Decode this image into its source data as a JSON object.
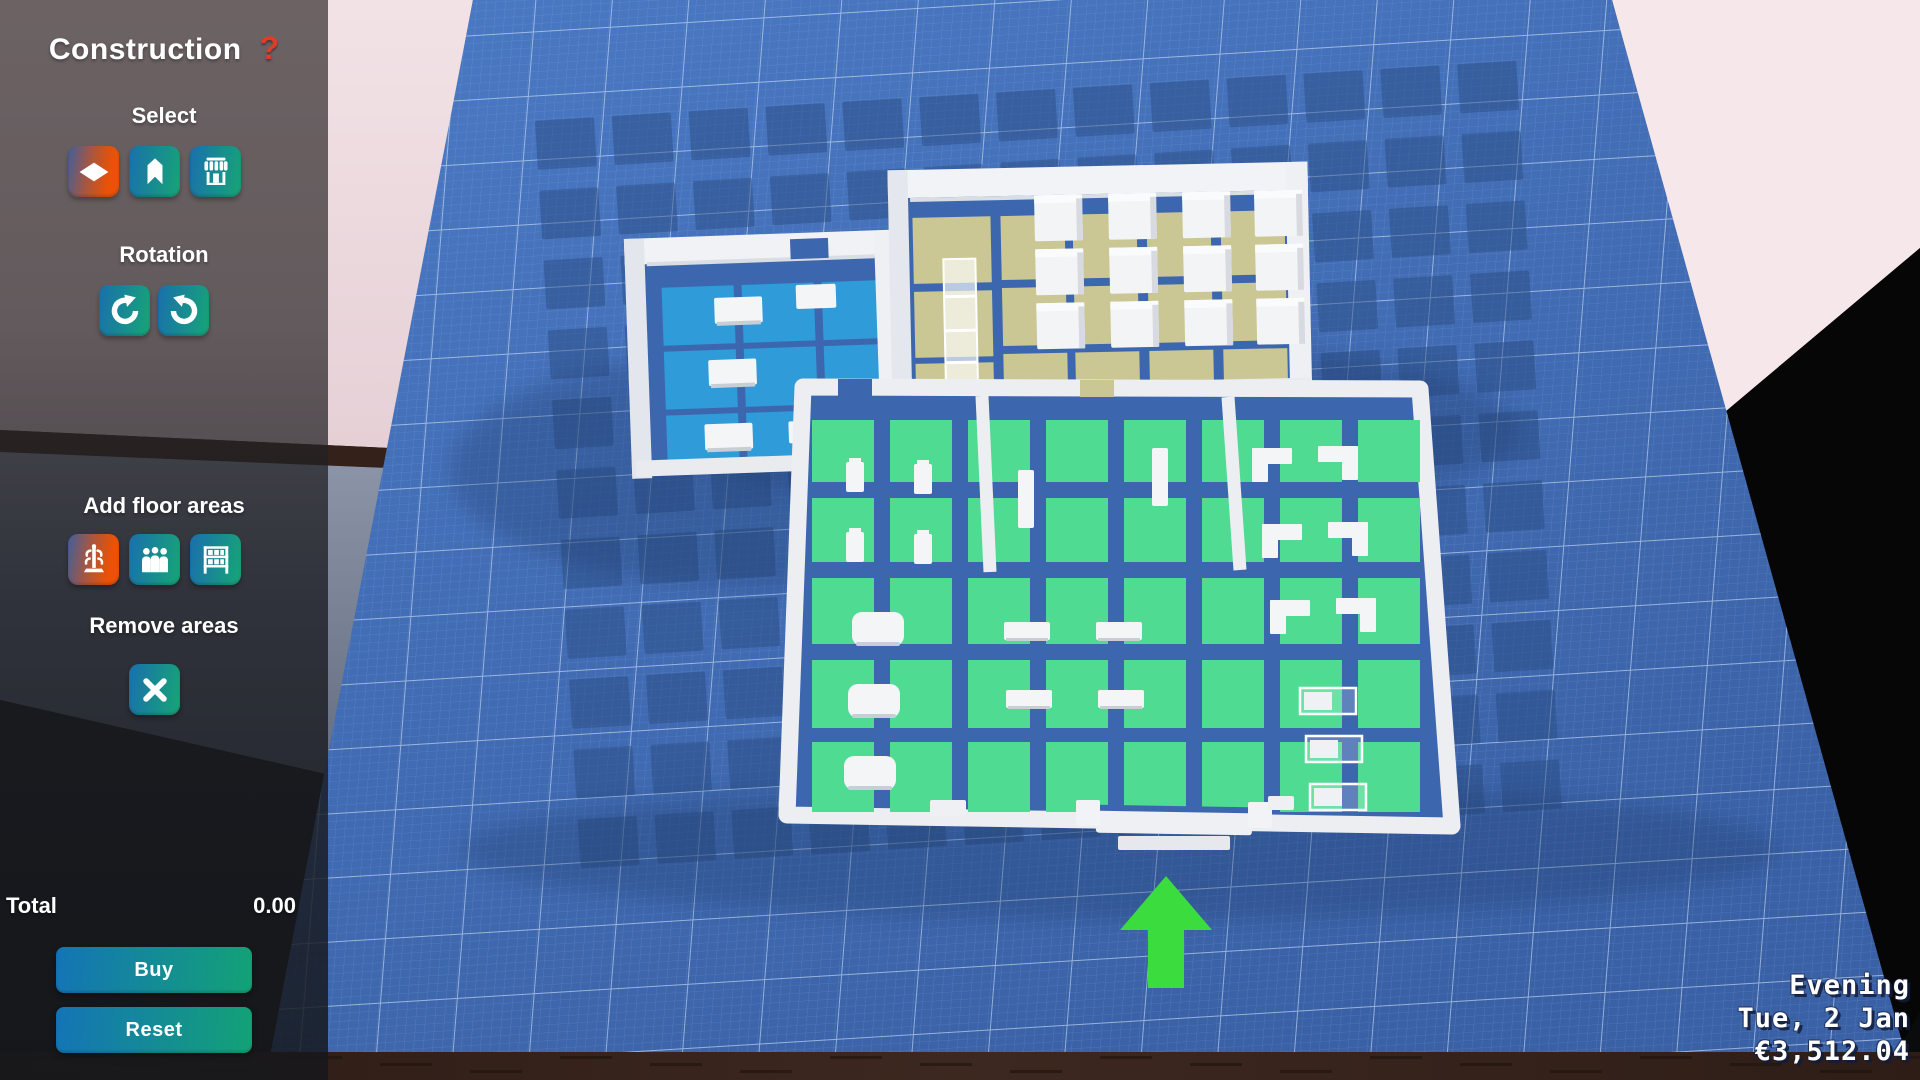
{
  "sidebar": {
    "title": "Construction",
    "help_label": "?",
    "select": {
      "label": "Select",
      "buttons": [
        {
          "icon": "floor-diamond-icon",
          "selected": true
        },
        {
          "icon": "walls-icon",
          "selected": false
        },
        {
          "icon": "store-icon",
          "selected": false
        }
      ]
    },
    "rotation": {
      "label": "Rotation",
      "buttons": [
        {
          "icon": "rotate-ccw-icon"
        },
        {
          "icon": "rotate-cw-icon"
        }
      ]
    },
    "add_floor_areas": {
      "label": "Add floor areas",
      "buttons": [
        {
          "icon": "coat-rack-icon",
          "selected": true
        },
        {
          "icon": "people-area-icon",
          "selected": false
        },
        {
          "icon": "shelving-area-icon",
          "selected": false
        }
      ]
    },
    "remove_areas": {
      "label": "Remove areas",
      "buttons": [
        {
          "icon": "x-icon"
        }
      ]
    },
    "total": {
      "label": "Total",
      "value": "0.00"
    },
    "buy_label": "Buy",
    "reset_label": "Reset"
  },
  "hud": {
    "time_of_day": "Evening",
    "date": "Tue, 2 Jan",
    "money": "€3,512.04"
  },
  "colors": {
    "blueprint_base_light": "#4a79c4",
    "blueprint_base_dark": "#3a61a6",
    "blueprint_dark_square": "#27497f",
    "grid_major": "#dceafc",
    "grid_minor": "#bcd4f0",
    "room_floor": "#3c67af",
    "tile_blue": "#2f9bd9",
    "tile_green": "#4fdb92",
    "tile_tan": "#cbc794",
    "wall_white": "#edeef2",
    "wall_shade": "#d9dde4",
    "furniture_white": "#f4f5f7",
    "furniture_shade": "#c9cdd6",
    "arrow_green": "#3bdc3e",
    "pink_wall": "#f0dfe3",
    "black_void": "#060606",
    "wood_floor": "#33211a",
    "carpet": "#808b9e",
    "accent_orange": "#e95207",
    "accent_teal_left": "#1a6fad",
    "accent_teal_right": "#16a576",
    "help_red": "#e03c28"
  }
}
